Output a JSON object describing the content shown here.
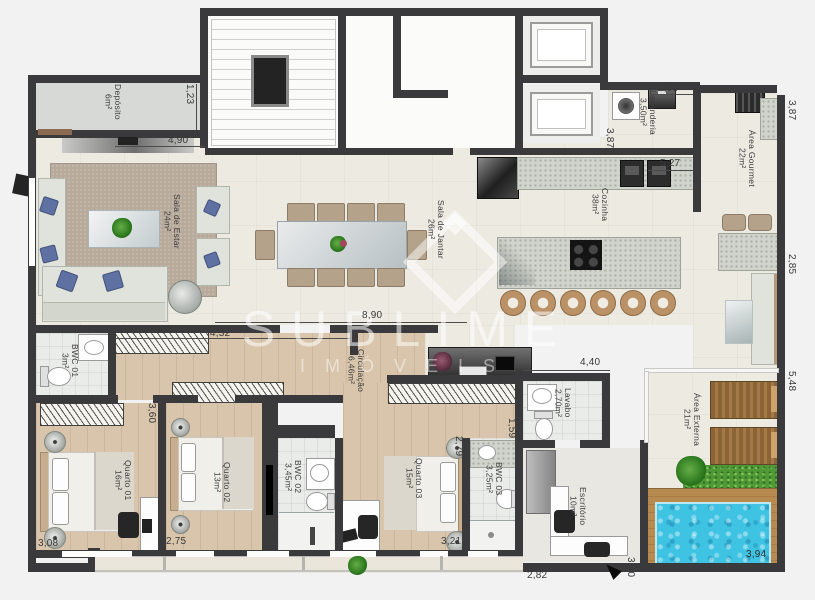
{
  "watermark": {
    "title": "SUBLIME",
    "subtitle": "IMÓVEIS"
  },
  "rooms": {
    "deposito": {
      "name": "Depósito",
      "area": "6m²"
    },
    "sala_estar": {
      "name": "Sala de Estar",
      "area": "24m²"
    },
    "sala_jantar": {
      "name": "Sala de Jantar",
      "area": "26m²"
    },
    "cozinha": {
      "name": "Cozinha",
      "area": "38m²"
    },
    "lavanderia": {
      "name": "Lavanderia",
      "area": "3,50m²"
    },
    "area_gourmet": {
      "name": "Área Gourmet",
      "area": "22m²"
    },
    "bwc01": {
      "name": "BWC 01",
      "area": "3m²"
    },
    "quarto01": {
      "name": "Quarto 01",
      "area": "16m²"
    },
    "quarto02": {
      "name": "Quarto 02",
      "area": "13m²"
    },
    "bwc02": {
      "name": "BWC 02",
      "area": "3,45m²"
    },
    "quarto03": {
      "name": "Quarto 03",
      "area": "15m²"
    },
    "bwc03": {
      "name": "BWC 03",
      "area": "3,25m²"
    },
    "lavabo": {
      "name": "Lavabo",
      "area": "2,70m²"
    },
    "escritorio": {
      "name": "Escritório",
      "area": "10m²"
    },
    "area_externa": {
      "name": "Área Externa",
      "area": "21m²"
    },
    "circulacao": {
      "name": "Circulação",
      "area": "6,46m²"
    }
  },
  "dims": {
    "d490": "4,90",
    "d123": "1,23",
    "d432": "4,32",
    "d890": "8,90",
    "d203": "2,03",
    "d527": "5,27",
    "d387a": "3,87",
    "d387b": "3,87",
    "d440": "4,40",
    "d345": "3,45",
    "d360": "3,60",
    "d308": "3,08",
    "d275": "2,75",
    "d287": "2,87",
    "d279": "2,79",
    "d321": "3,21",
    "d159": "1,59",
    "d282": "2,82",
    "d350a": "3,50",
    "d285": "2,85",
    "d548": "5,48",
    "d394": "3,94"
  },
  "colors": {
    "wall": "#3a3a3c",
    "pool": "#3fc3e3",
    "wood_floor": "#d9c5ac",
    "deck": "#b4874f",
    "grass": "#4f9a37",
    "beige_floor": "#edeae2",
    "watermark": "rgba(255,255,255,0.55)"
  },
  "furniture": [
    "sofa",
    "armchair",
    "coffee-table",
    "rug",
    "dining-table",
    "dining-chair",
    "kitchen-island",
    "cooktop",
    "bar-stool",
    "fridge",
    "sink",
    "washer",
    "grill",
    "bed",
    "nightstand-lamp",
    "wardrobe",
    "toilet",
    "shower",
    "desk",
    "office-chair",
    "tv-panel",
    "sideboard",
    "lounger",
    "pool",
    "plant",
    "north-arrow",
    "stairs",
    "elevator"
  ]
}
